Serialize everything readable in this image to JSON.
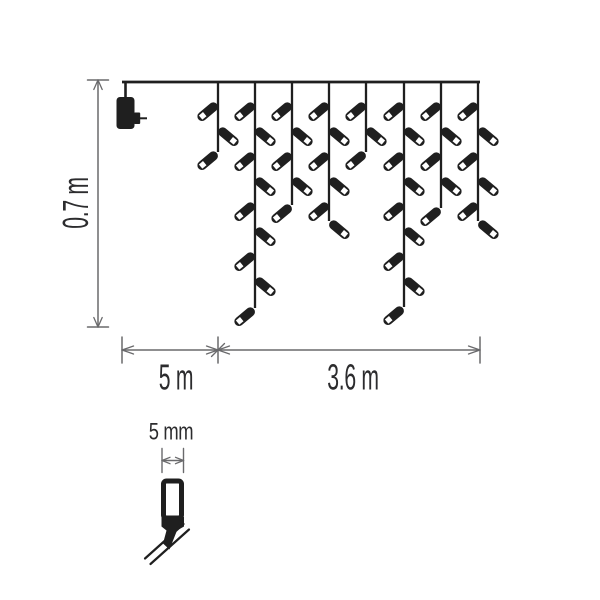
{
  "labels": {
    "drop_height": "0.7 m",
    "lead_length": "5 m",
    "lit_length": "3.6 m",
    "bulb_size": "5 mm"
  },
  "colors": {
    "ink": "#1f1f1f",
    "dimension": "#6a6a6c",
    "text": "#2c2c2e",
    "background": "#ffffff"
  },
  "diagram": {
    "type": "dimension-diagram",
    "subject": "christmas-icicle-string-lights",
    "top_line": {
      "x1": 122,
      "y": 82,
      "x2": 480
    },
    "adapter": {
      "x": 125.5,
      "top": 97
    },
    "strands": [
      {
        "x": 218,
        "bottom": 152
      },
      {
        "x": 255,
        "bottom": 308
      },
      {
        "x": 292,
        "bottom": 205
      },
      {
        "x": 329,
        "bottom": 221
      },
      {
        "x": 366,
        "bottom": 152
      },
      {
        "x": 404,
        "bottom": 307
      },
      {
        "x": 441,
        "bottom": 208
      },
      {
        "x": 478,
        "bottom": 221
      }
    ],
    "bulbs": {
      "first_y": 103,
      "spacing": 25,
      "first_side": "left"
    },
    "dimensions": {
      "height": {
        "x": 98,
        "y1": 80,
        "y2": 327
      },
      "width": {
        "y": 350,
        "x_start": 122,
        "x_mid": 218,
        "x_end": 480
      },
      "bulb": {
        "y": 460.5,
        "x1": 162,
        "x2": 183.5
      }
    },
    "bulb_detail": {
      "body_x": 163.5,
      "body_y": 481,
      "body_w": 18,
      "body_h": 37
    }
  }
}
